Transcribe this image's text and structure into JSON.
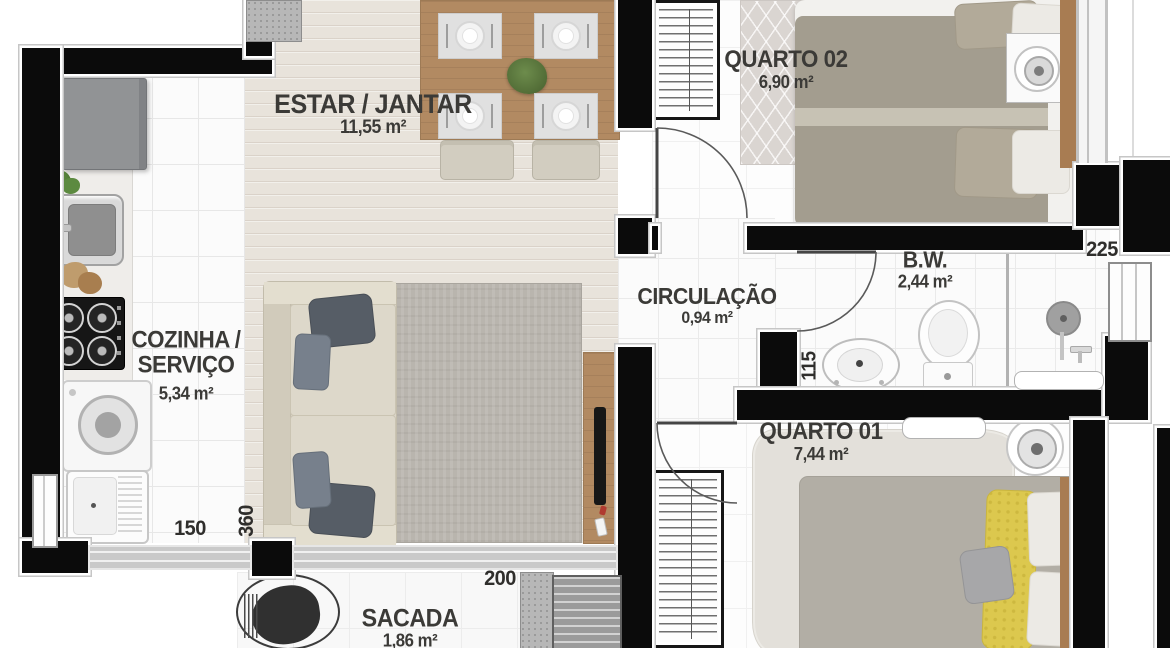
{
  "rooms": {
    "estar_jantar": {
      "name": "ESTAR / JANTAR",
      "area": "11,55 m²"
    },
    "cozinha": {
      "name_line1": "COZINHA /",
      "name_line2": "SERVIÇO",
      "area": "5,34 m²"
    },
    "quarto02": {
      "name": "QUARTO 02",
      "area": "6,90 m²"
    },
    "bw": {
      "name": "B.W.",
      "area": "2,44 m²"
    },
    "circulacao": {
      "name": "CIRCULAÇÃO",
      "area": "0,94 m²"
    },
    "quarto01": {
      "name": "QUARTO 01",
      "area": "7,44 m²"
    },
    "sacada": {
      "name": "SACADA",
      "area": "1,86 m²"
    }
  },
  "dimensions_cm": {
    "service_width": "150",
    "living_depth": "360",
    "sacada_width": "200",
    "bathroom_length": "225",
    "bathroom_width": "115"
  },
  "colors": {
    "wall": "#0b0b0b",
    "wood_floor": "#e8e3db",
    "living_rug": "#b9b5ae",
    "duvet_gray": "#a39d8f",
    "pillow_yellow": "#dcc84e",
    "label_text": "#3b3a37"
  }
}
